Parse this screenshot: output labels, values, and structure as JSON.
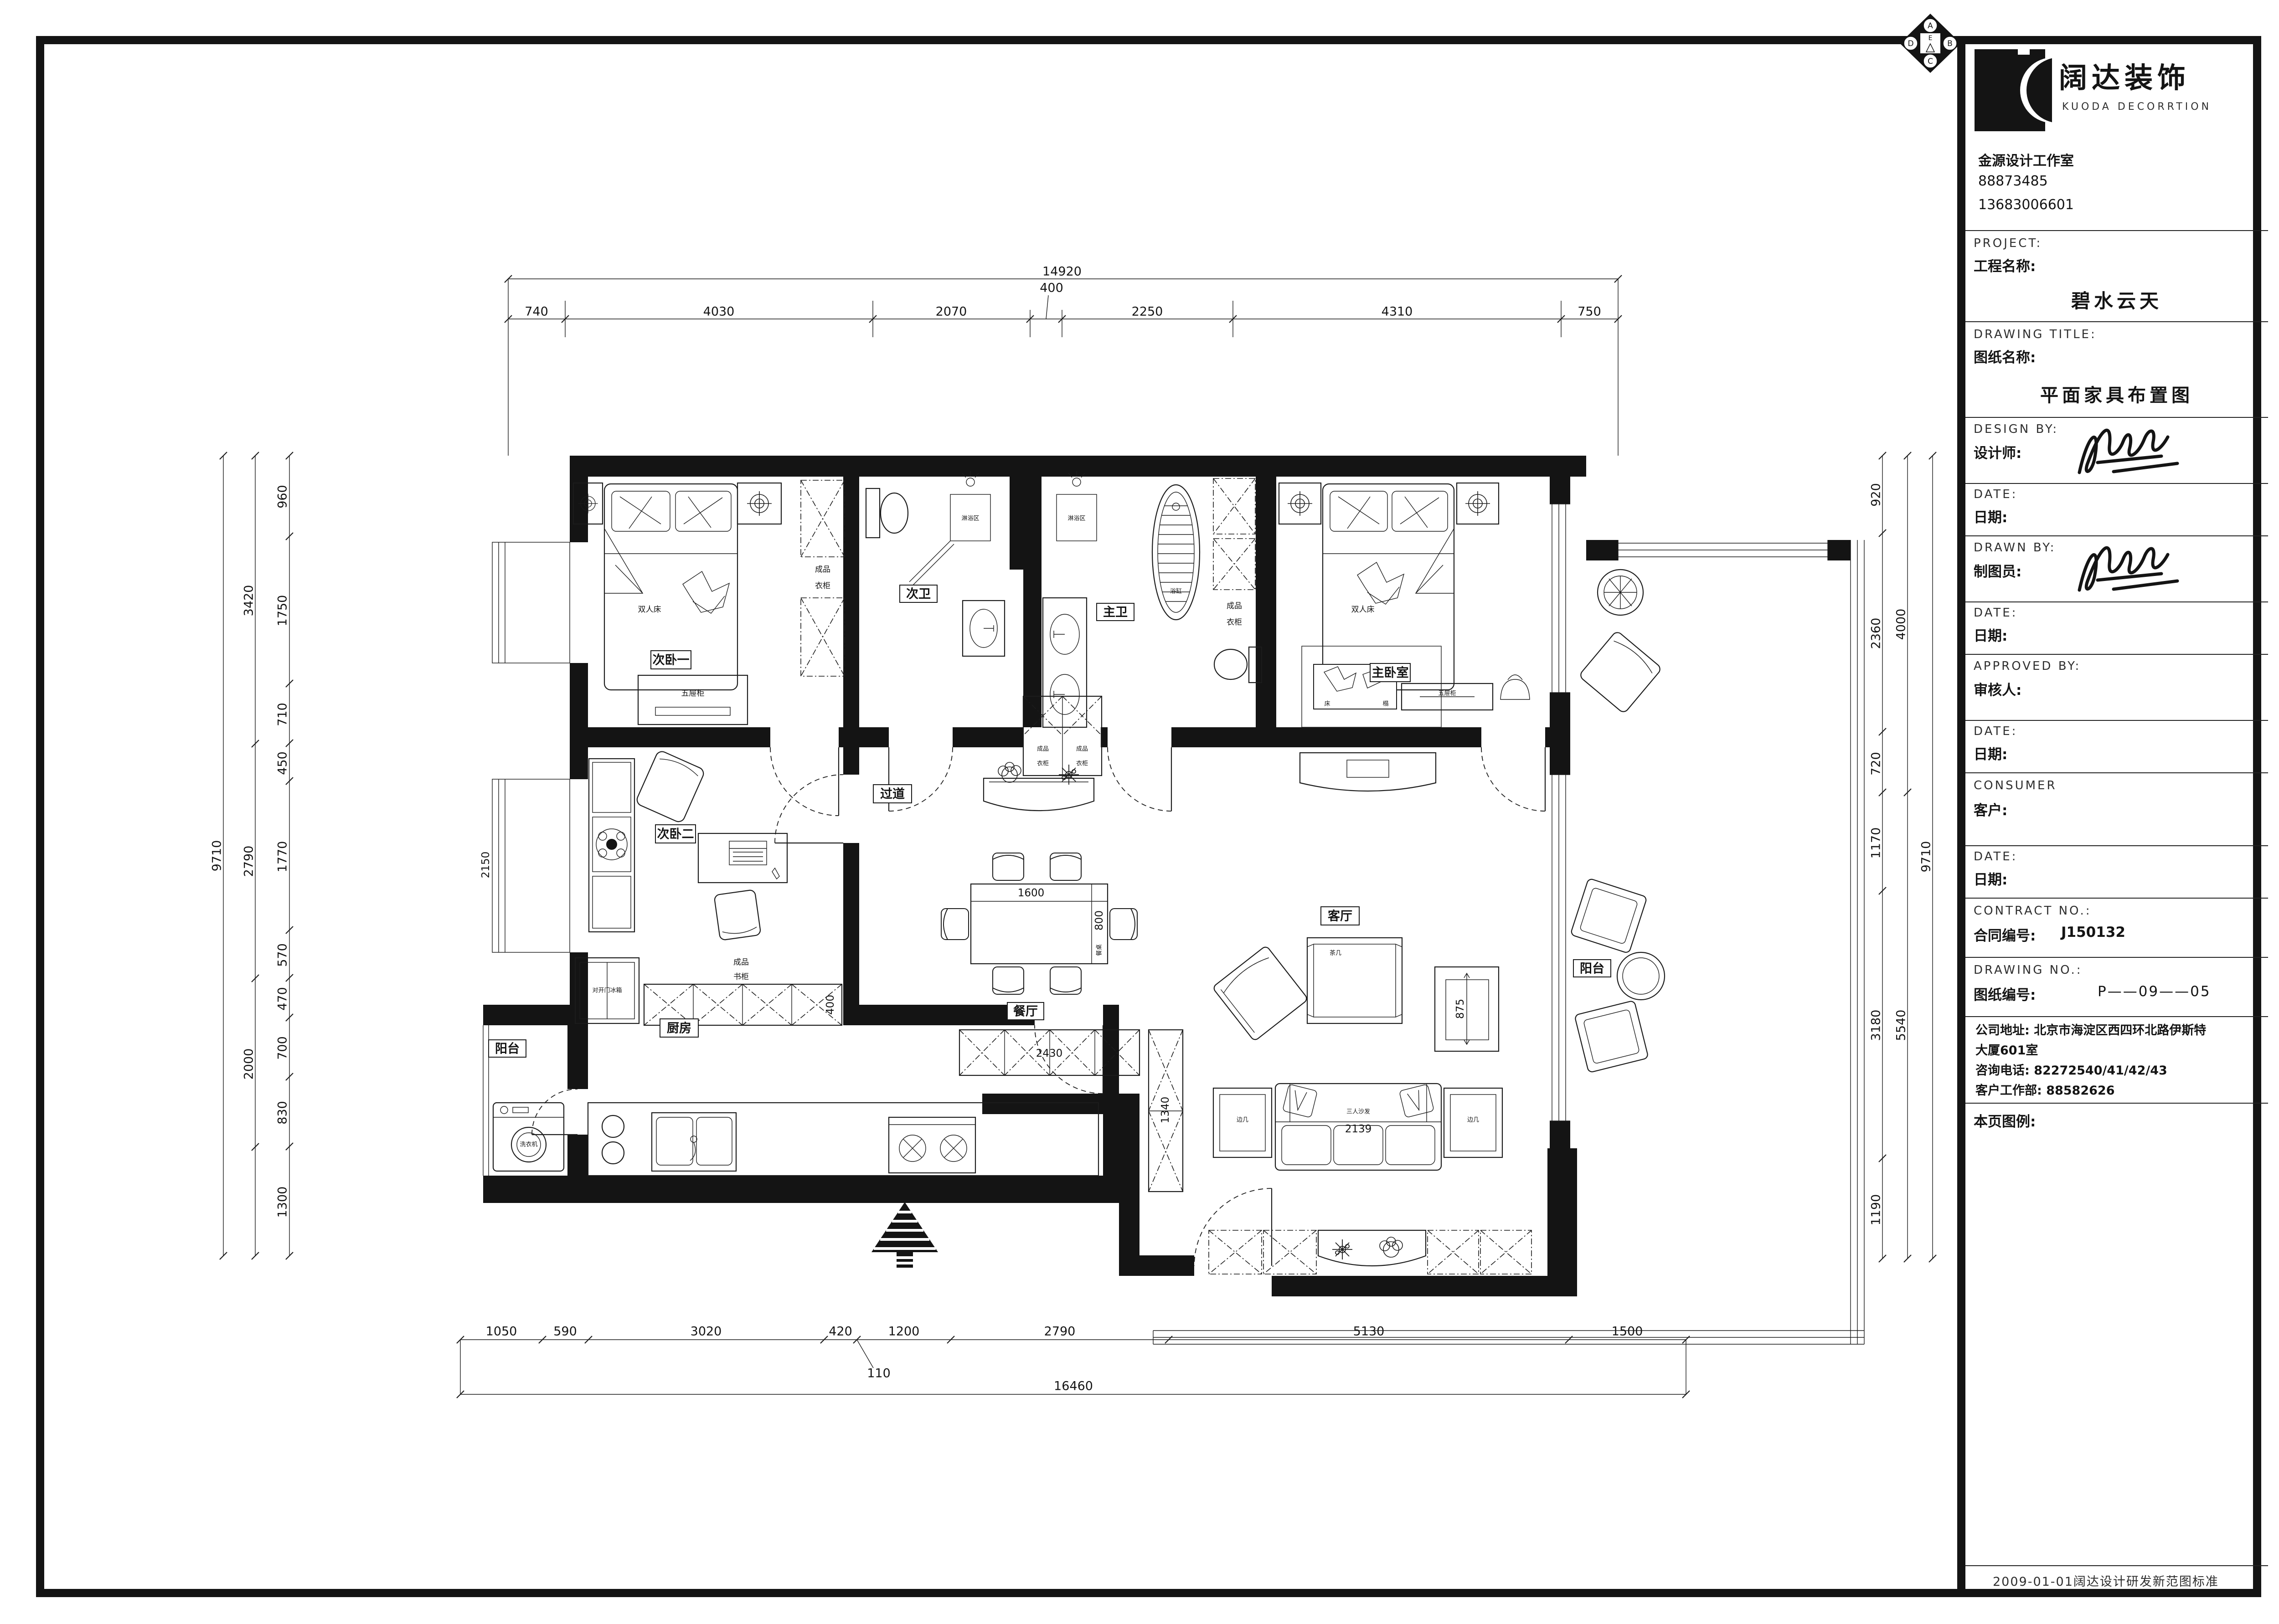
{
  "brand": {
    "name_cn": "阔达装饰",
    "name_en": "KUODA DECORRTION",
    "studio": "金源设计工作室",
    "phone1": "88873485",
    "phone2": "13683006601"
  },
  "compass": {
    "n": "A",
    "e": "B",
    "s": "C",
    "w": "D",
    "c": "E"
  },
  "tb": {
    "project_en": "PROJECT:",
    "project_cn": "工程名称:",
    "project_value": "碧水云天",
    "dtitle_en": "DRAWING TITLE:",
    "dtitle_cn": "图纸名称:",
    "dtitle_value": "平面家具布置图",
    "design_en": "DESIGN BY:",
    "design_cn": "设计师:",
    "date_en": "DATE:",
    "date_cn": "日期:",
    "drawn_en": "DRAWN BY:",
    "drawn_cn": "制图员:",
    "approved_en": "APPROVED BY:",
    "approved_cn": "审核人:",
    "consumer_en": "CONSUMER",
    "consumer_cn": "客户:",
    "contract_en": "CONTRACT NO.:",
    "contract_cn": "合同编号:",
    "contract_value": "J150132",
    "drawno_en": "DRAWING NO.:",
    "drawno_cn": "图纸编号:",
    "drawno_value": "P——09——05",
    "addr1": "公司地址: 北京市海淀区西四环北路伊斯特",
    "addr2": "大厦601室",
    "addr3": "咨询电话: 82272540/41/42/43",
    "addr4": "客户工作部: 88582626",
    "legend": "本页图例:",
    "footer": "2009-01-01阔达设计研发新范图标准"
  },
  "rooms": {
    "bed1": "次卧一",
    "bath2": "次卫",
    "bath1": "主卫",
    "master": "主卧室",
    "bed2": "次卧二",
    "hall": "过道",
    "dining": "餐厅",
    "living": "客厅",
    "kitchen": "厨房",
    "balcony": "阳台"
  },
  "furn": {
    "bed": "双人床",
    "wa": "成品",
    "wb": "衣柜",
    "ba": "成品",
    "bb": "书柜",
    "drawer": "五屉柜",
    "shower": "淋浴区",
    "tub": "浴缸",
    "table": "餐桌",
    "tea": "茶几",
    "sofa": "三人沙发",
    "side": "边几",
    "washer": "洗衣机",
    "fridge": "对开门冰箱",
    "bencha": "床",
    "benchb": "榻"
  },
  "dims": {
    "top": {
      "total": "14920",
      "s": [
        "740",
        "4030",
        "2070",
        "400",
        "2250",
        "4310",
        "750"
      ]
    },
    "bottom": {
      "total": "16460",
      "off": "110",
      "s": [
        "1050",
        "590",
        "3020",
        "420",
        "1200",
        "2790",
        "5130",
        "1500"
      ]
    },
    "left": {
      "outer": "9710",
      "mid": [
        "3420",
        "2790",
        "2000"
      ],
      "inner": [
        "960",
        "1750",
        "710",
        "450",
        "1770",
        "570",
        "470",
        "700",
        "830",
        "1300"
      ]
    },
    "right": {
      "outer": "9710",
      "mid": [
        "4000",
        "5540"
      ],
      "inner": [
        "920",
        "2360",
        "720",
        "1170",
        "3180",
        "1190"
      ]
    },
    "inline": {
      "tw": "1600",
      "td": "800",
      "sofa": "2139",
      "chair": "875",
      "sb": "2430",
      "shoe": "1340",
      "bk": "400",
      "bay": "2150"
    }
  }
}
